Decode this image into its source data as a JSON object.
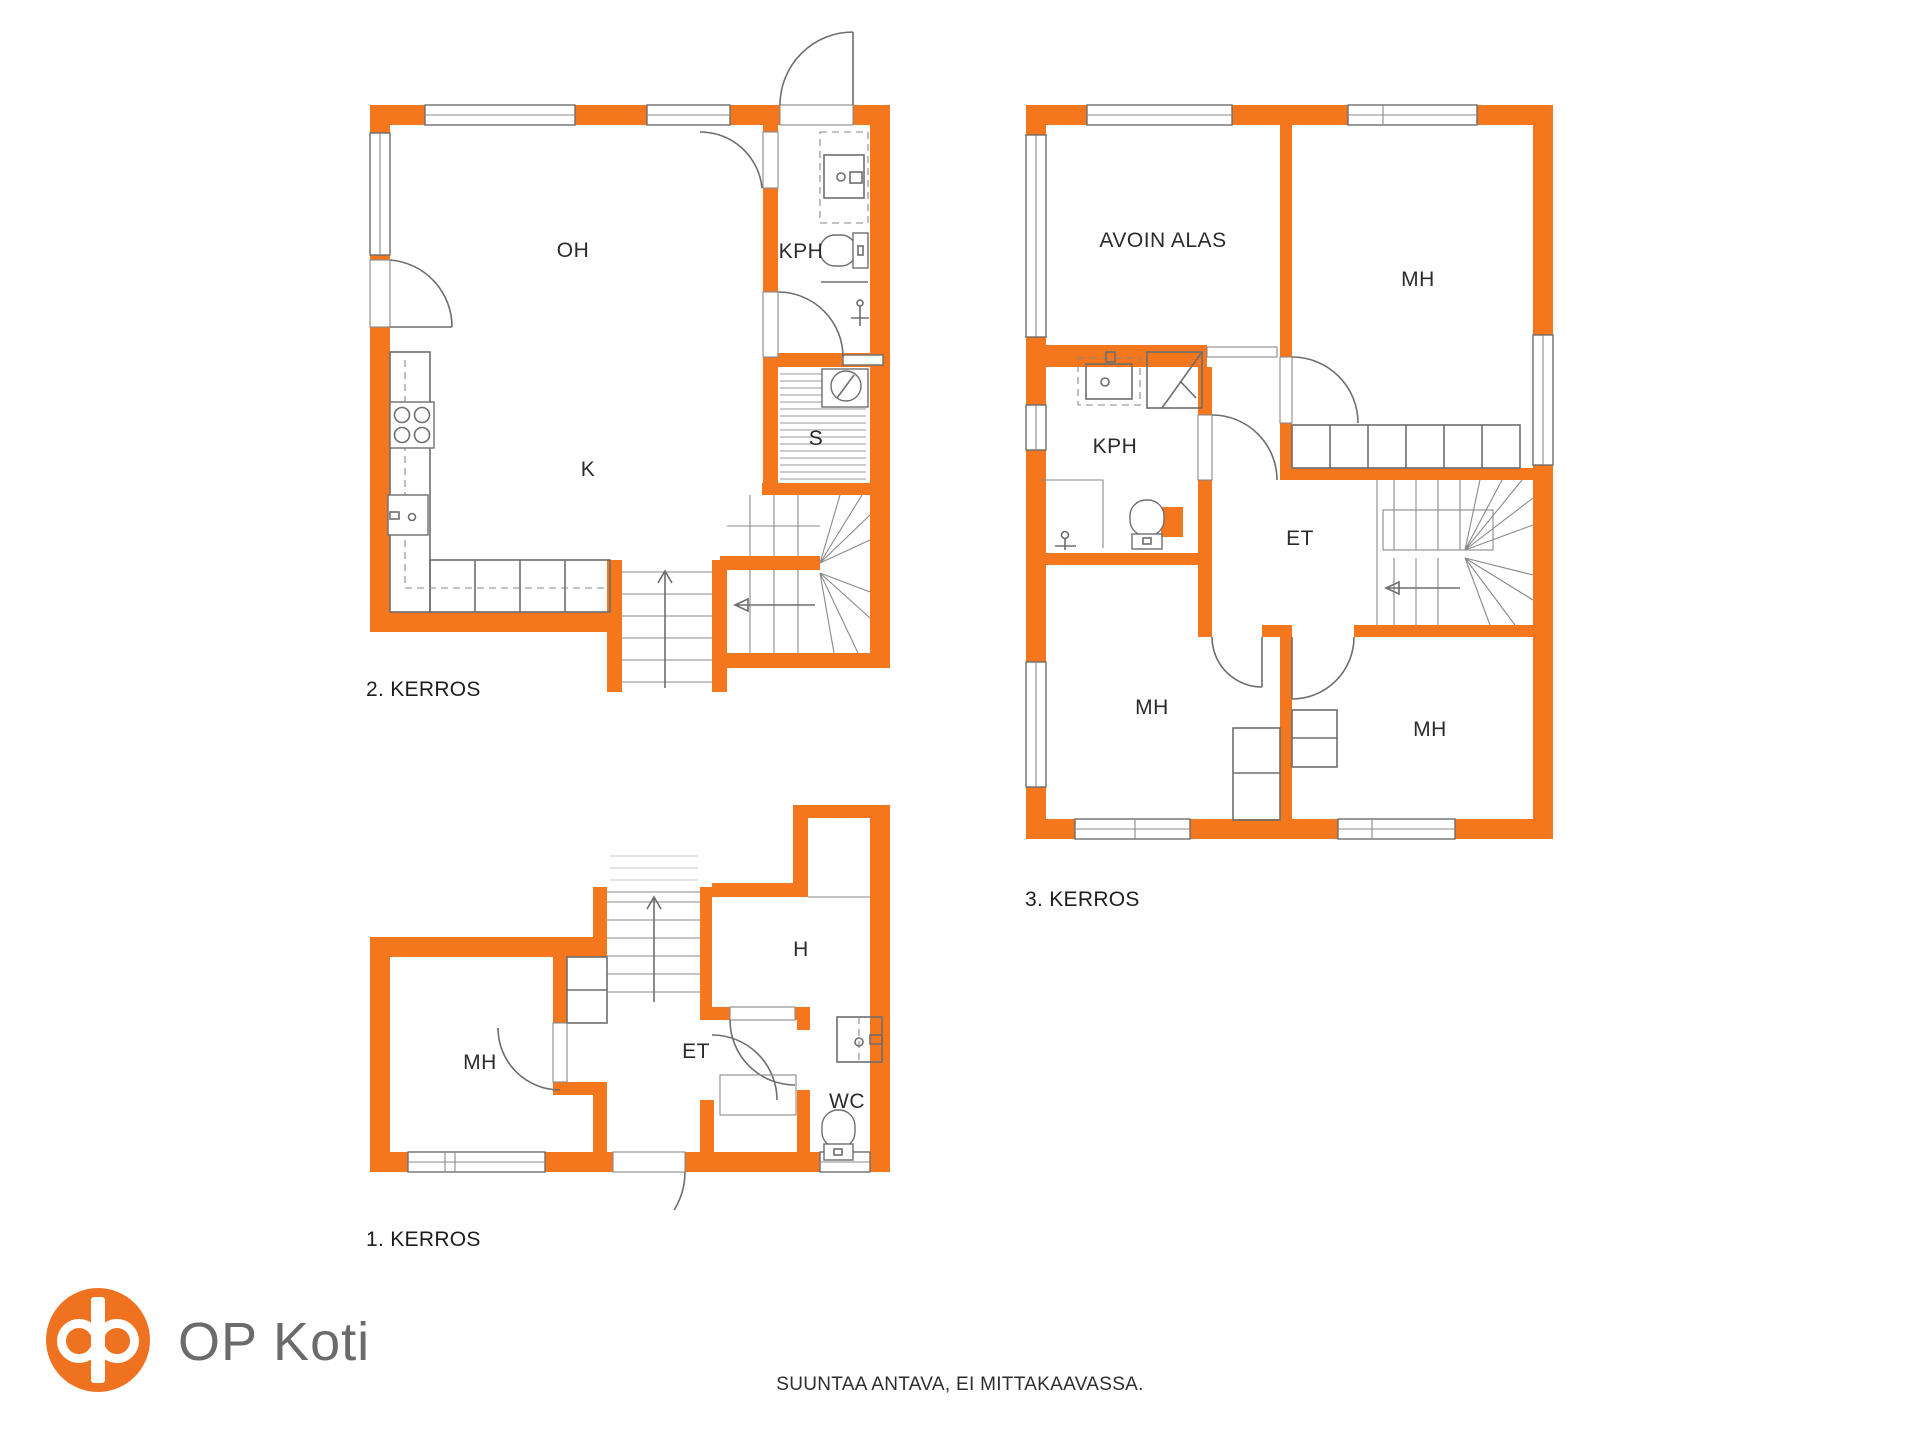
{
  "colors": {
    "wall_orange": "#F4761D",
    "line_gray": "#6E6E6E",
    "brand_orange": "#EE7220",
    "brand_text_gray": "#6B6B6B"
  },
  "floors": {
    "floor2": {
      "label": "2. KERROS",
      "rooms": {
        "oh": "OH",
        "kph": "KPH",
        "k": "K",
        "s": "S"
      }
    },
    "floor3": {
      "label": "3. KERROS",
      "rooms": {
        "avoin": "AVOIN ALAS",
        "mh_top": "MH",
        "kph": "KPH",
        "et": "ET",
        "mh_left": "MH",
        "mh_right": "MH"
      }
    },
    "floor1": {
      "label": "1. KERROS",
      "rooms": {
        "mh": "MH",
        "et": "ET",
        "h": "H",
        "wc": "WC"
      }
    }
  },
  "brand": {
    "name": "OP Koti"
  },
  "footer": {
    "disclaimer": "SUUNTAA ANTAVA, EI MITTAKAAVASSA."
  }
}
